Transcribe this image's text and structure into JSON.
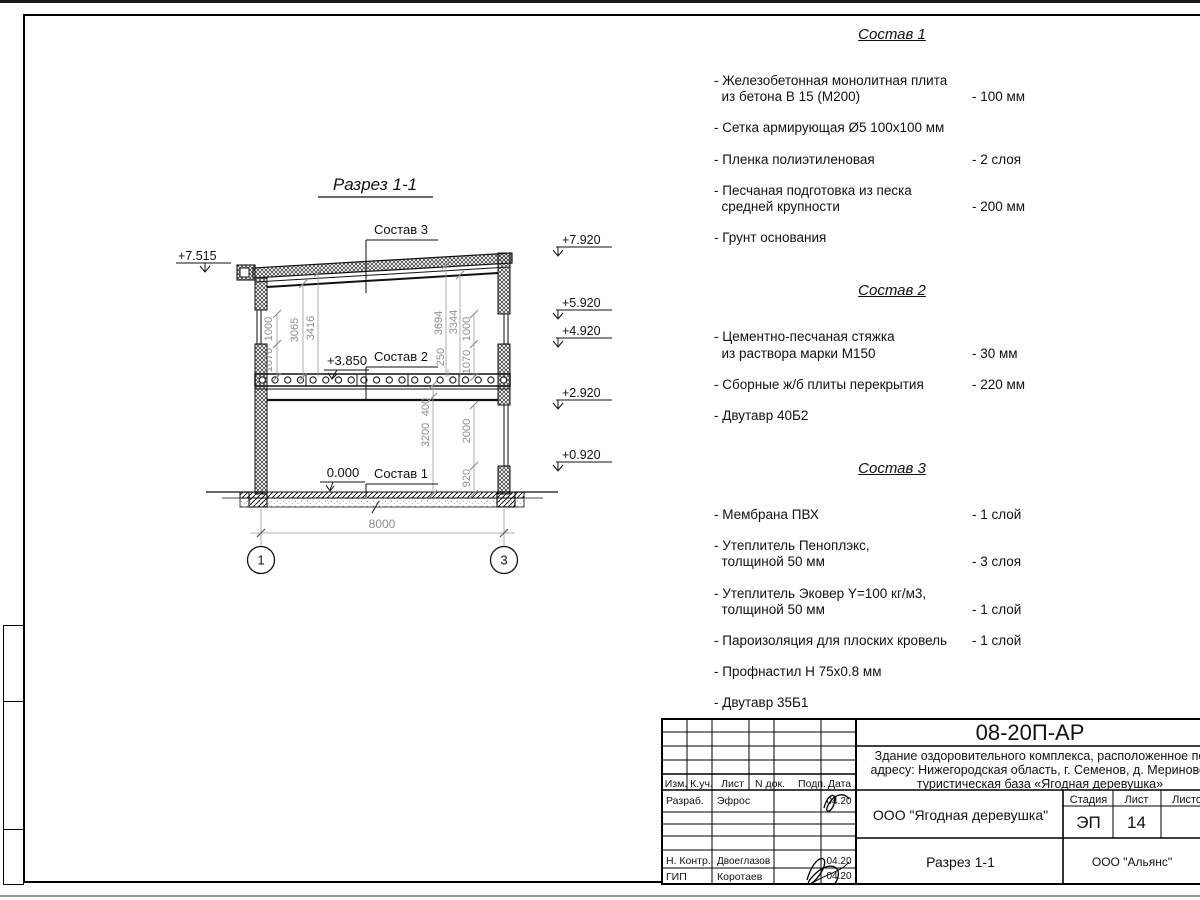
{
  "drawing": {
    "title": "Разрез 1-1",
    "callouts": {
      "c1": "Состав 1",
      "c2": "Состав 2",
      "c3": "Состав 3",
      "lvl385": "+3.850",
      "lvl0": "0.000"
    },
    "elev": {
      "l1": "+7.515",
      "r1": "+7.920",
      "r2": "+5.920",
      "r3": "+4.920",
      "r4": "+2.920",
      "r5": "+0.920"
    },
    "dims": {
      "l1070": "1070",
      "l1000": "1000",
      "l3065": "3065",
      "l3416": "3416",
      "r3694": "3694",
      "r3344": "3344",
      "r250": "250",
      "r1070": "1070",
      "r1000": "1000",
      "b3200": "3200",
      "b400": "400",
      "b2000": "2000",
      "b920": "920",
      "span": "8000"
    },
    "axes": {
      "a1": "1",
      "a2": "3"
    }
  },
  "compositions": [
    {
      "title": "Состав 1",
      "items": [
        {
          "name": "- Железобетонная  монолитная плита\n  из бетона В 15 (М200)",
          "value": "- 100 мм"
        },
        {
          "name": "- Сетка армирующая Ø5 100х100 мм",
          "value": ""
        },
        {
          "name": "- Пленка полиэтиленовая",
          "value": "-  2 слоя"
        },
        {
          "name": "- Песчаная подготовка из песка\n  средней крупности",
          "value": "- 200 мм"
        },
        {
          "name": "- Грунт основания",
          "value": ""
        }
      ]
    },
    {
      "title": "Состав 2",
      "items": [
        {
          "name": "- Цементно-песчаная стяжка\n  из раствора марки М150",
          "value": "- 30 мм"
        },
        {
          "name": "- Сборные ж/б плиты перекрытия",
          "value": "- 220 мм"
        },
        {
          "name": "- Двутавр 40Б2",
          "value": ""
        }
      ]
    },
    {
      "title": "Состав 3",
      "items": [
        {
          "name": "- Мембрана ПВХ",
          "value": "- 1 слой"
        },
        {
          "name": "- Утеплитель Пеноплэкс,\n  толщиной 50 мм",
          "value": "- 3 слоя"
        },
        {
          "name": "- Утеплитель Эковер Y=100 кг/м3,\n  толщиной 50 мм",
          "value": "- 1 слой"
        },
        {
          "name": "- Пароизоляция для плоских кровель",
          "value": "- 1 слой"
        },
        {
          "name": "- Профнастил Н 75х0.8 мм",
          "value": ""
        },
        {
          "name": "- Двутавр 35Б1",
          "value": ""
        }
      ]
    }
  ],
  "titleblock": {
    "code": "08-20П-АР",
    "project_line1": "Здание оздоровительного комплекса, расположенное по",
    "project_line2": "адресу: Нижегородская область, г. Семенов, д. Мериново,",
    "project_line3": "туристическая база «Ягодная деревушка»",
    "org": "ООО \"Ягодная деревушка\"",
    "sheet_title": "Разрез 1-1",
    "contractor": "ООО \"Альянс\"",
    "stage_label": "Стадия",
    "stage": "ЭП",
    "sheet_label": "Лист",
    "sheet": "14",
    "sheets_label": "Листов",
    "cols": [
      "Изм.",
      "К.уч.",
      "Лист",
      "N док.",
      "Подп.",
      "Дата"
    ],
    "rows": [
      {
        "role": "Разраб.",
        "name": "Эфрос",
        "date": "04.20"
      },
      {
        "role": "Н. Контр.",
        "name": "Двоеглазов",
        "date": "04.20"
      },
      {
        "role": "ГИП",
        "name": "Коротаев",
        "date": "04.20"
      }
    ]
  }
}
